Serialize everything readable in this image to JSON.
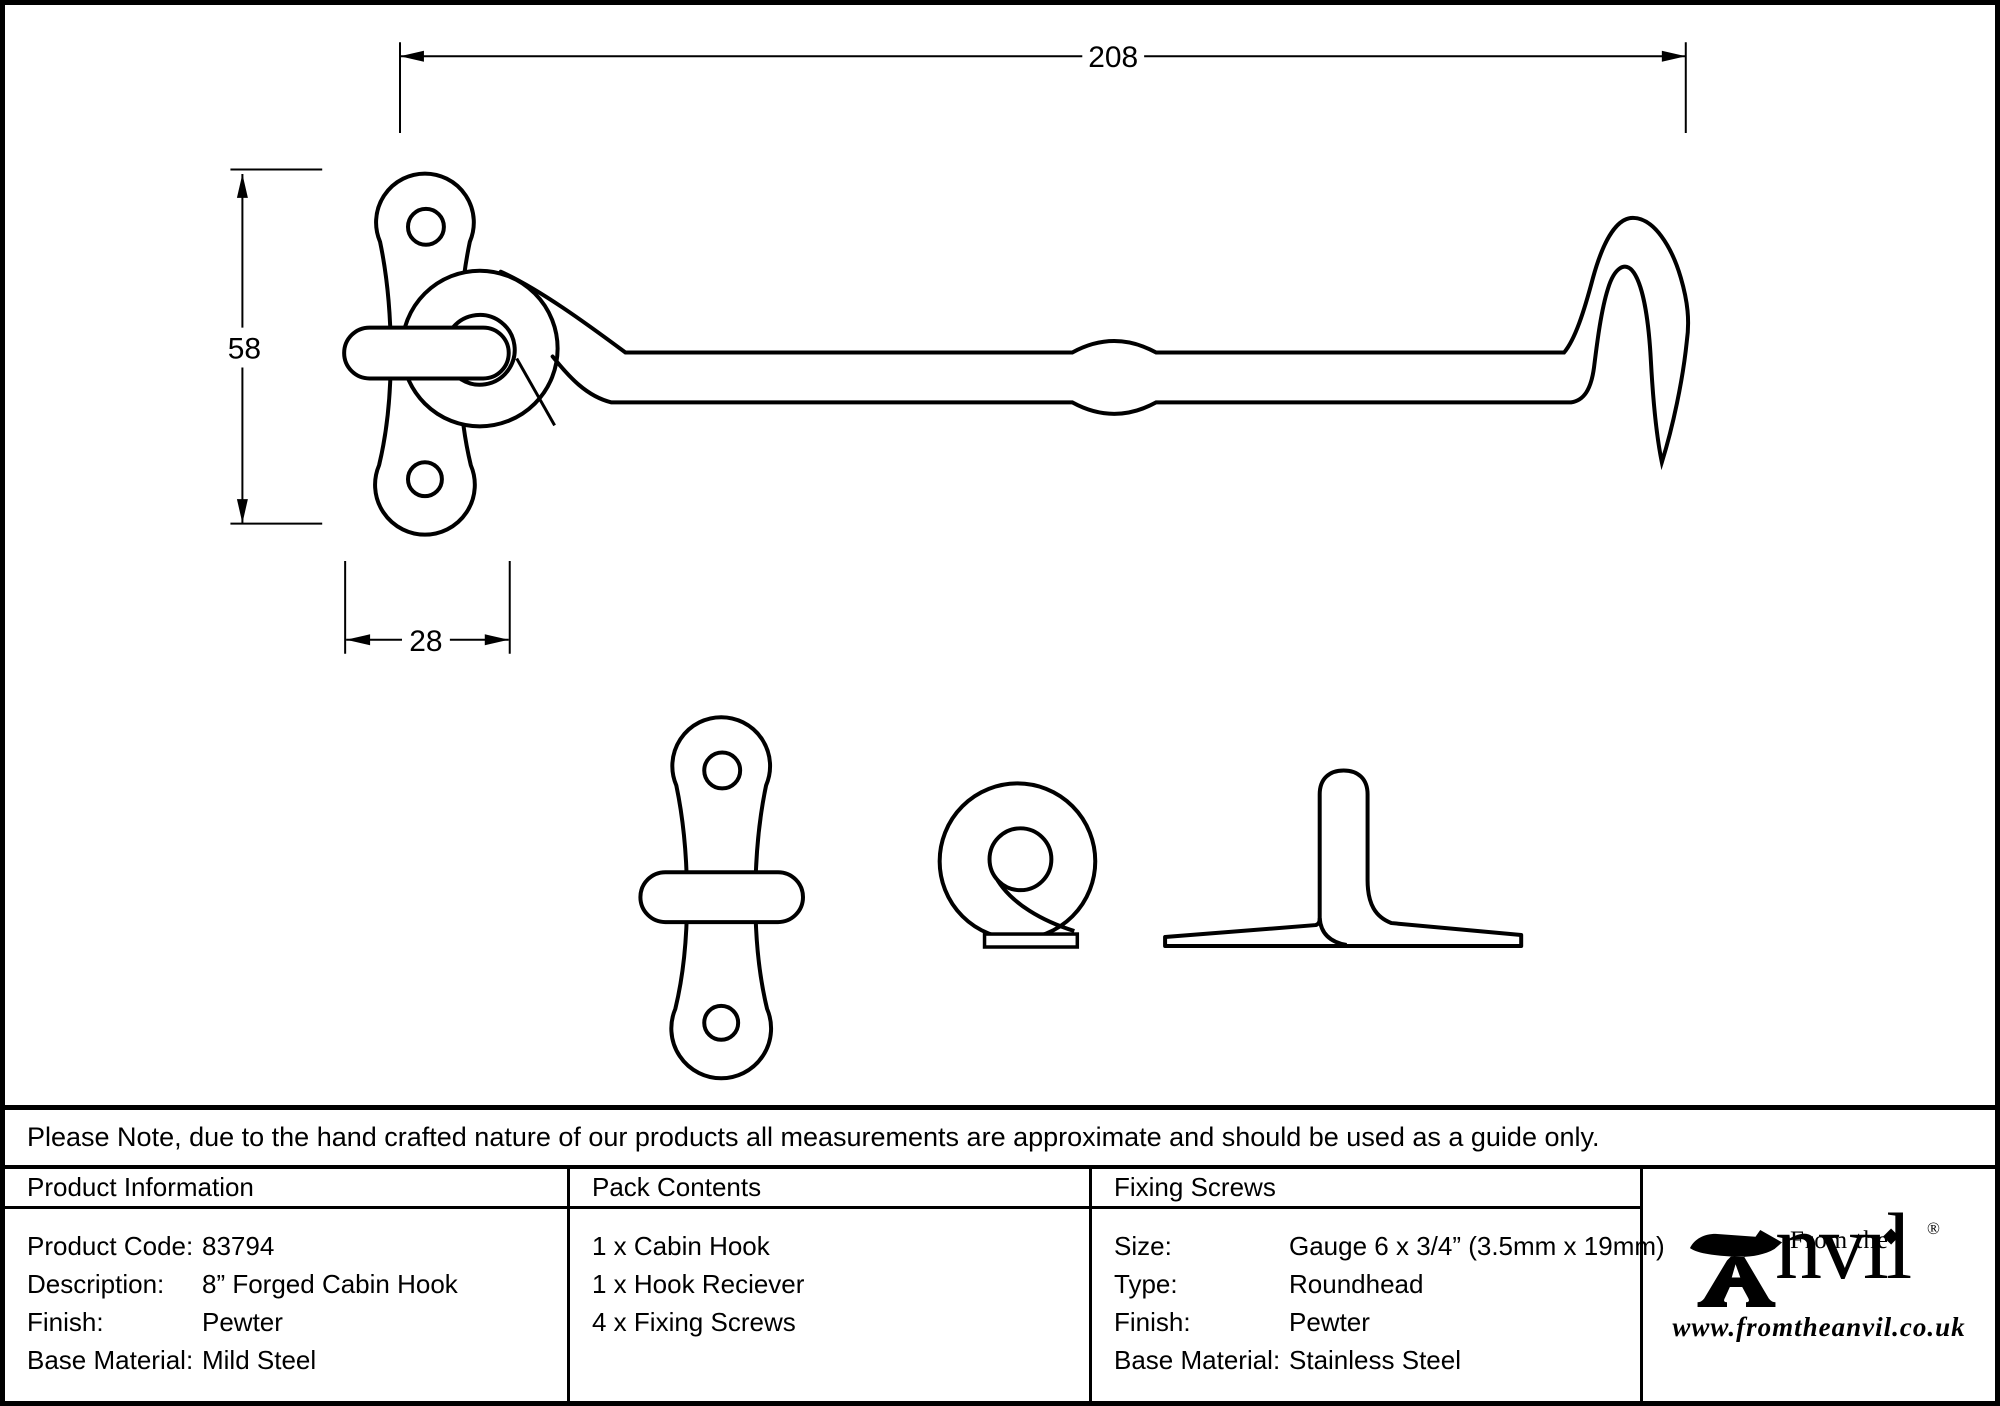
{
  "drawing": {
    "dim_length": "208",
    "dim_plate_height": "58",
    "dim_plate_width": "28"
  },
  "note": "Please Note, due to the hand crafted nature of our products all measurements are approximate and should be used as a guide only.",
  "product_information": {
    "title": "Product Information",
    "rows": [
      {
        "label": "Product Code:",
        "value": "83794"
      },
      {
        "label": "Description:",
        "value": "8” Forged Cabin Hook"
      },
      {
        "label": "Finish:",
        "value": "Pewter"
      },
      {
        "label": "Base Material:",
        "value": "Mild Steel"
      }
    ]
  },
  "pack_contents": {
    "title": "Pack Contents",
    "items": [
      "1 x Cabin Hook",
      "1 x Hook Reciever",
      "4 x Fixing Screws"
    ]
  },
  "fixing_screws": {
    "title": "Fixing Screws",
    "rows": [
      {
        "label": "Size:",
        "value": "Gauge 6 x 3/4” (3.5mm x 19mm)"
      },
      {
        "label": "Type:",
        "value": "Roundhead"
      },
      {
        "label": "Finish:",
        "value": "Pewter"
      },
      {
        "label": "Base Material:",
        "value": "Stainless Steel"
      }
    ]
  },
  "logo": {
    "prefix": "From the",
    "brand_suffix": "nvıl",
    "diamond": "◆",
    "registered": "®",
    "website": "www.fromtheanvil.co.uk"
  }
}
